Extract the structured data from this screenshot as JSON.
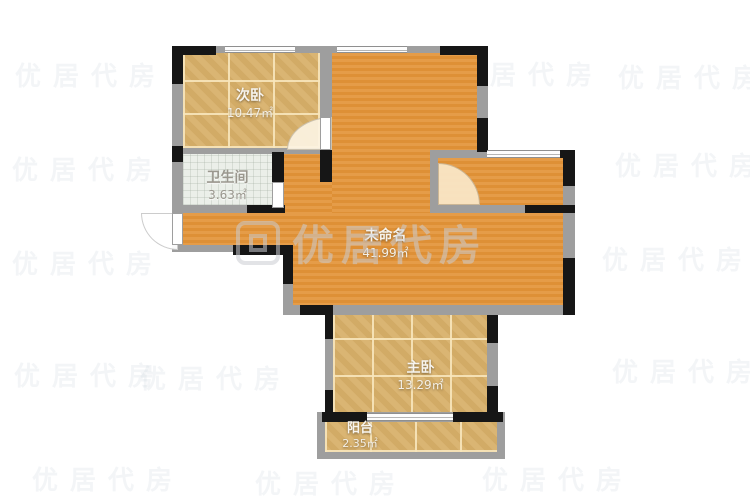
{
  "floorplan": {
    "rooms": [
      {
        "name": "次卧",
        "area": "10.47㎡"
      },
      {
        "name": "卫生间",
        "area": "3.63㎡"
      },
      {
        "name": "未命名",
        "area": "41.99㎡"
      },
      {
        "name": "主卧",
        "area": "13.29㎡"
      },
      {
        "name": "阳台",
        "area": "2.35㎡"
      }
    ],
    "colors": {
      "floor_orange": "#e0953e",
      "floor_tile_tan": "#d8b272",
      "floor_bathroom": "#ebefe9",
      "wall_gray": "#9e9e9e",
      "wall_black": "#161616",
      "label_text": "#f7f4ee"
    }
  },
  "watermark": {
    "brand_text": "优居代房",
    "tile_text": "优居代房"
  }
}
